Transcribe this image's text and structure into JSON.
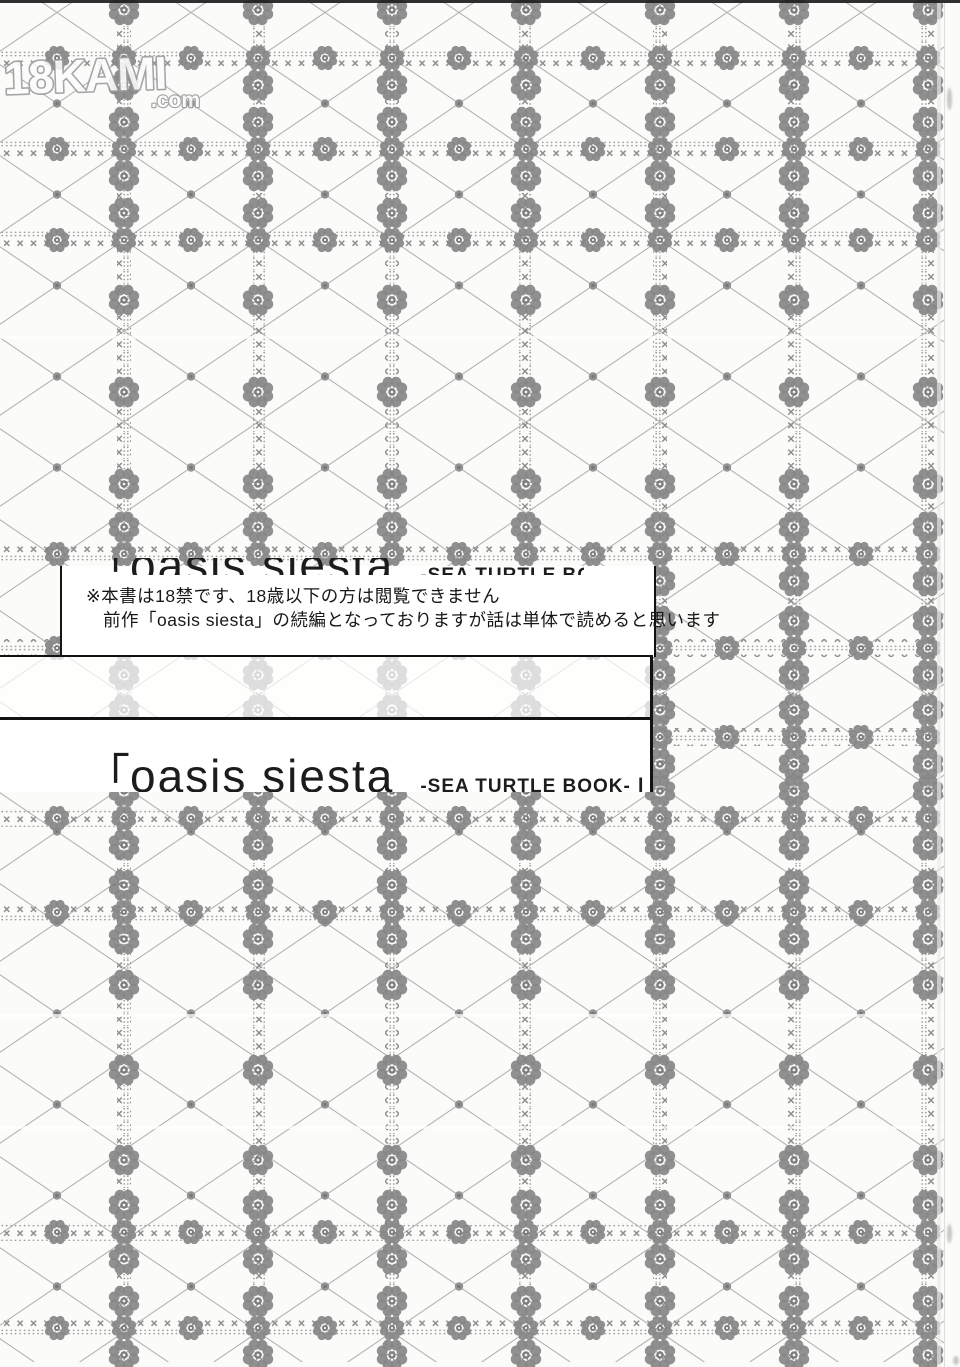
{
  "watermark": {
    "brand": "18KAMI",
    "suffix": ".com"
  },
  "age_notice": {
    "line1": "※本書は18禁です、18歳以下の方は閲覧できません",
    "line2": "前作「oasis siesta」の続編となっておりますが話は単体で読めると思います"
  },
  "title": {
    "bracket_open": "「",
    "main": "oasis siesta",
    "subtitle": "-SEA TURTLE BOOK-",
    "bracket_close": "」"
  },
  "colors": {
    "page_bg": "#fbfbf9",
    "pattern_ink": "#a0a0a0",
    "stitch_ink": "#8e8e8e",
    "flower_ink": "#878787",
    "text_ink": "#1c1c1c",
    "border_ink": "#121212",
    "watermark_grey": "#9b9b9b"
  }
}
